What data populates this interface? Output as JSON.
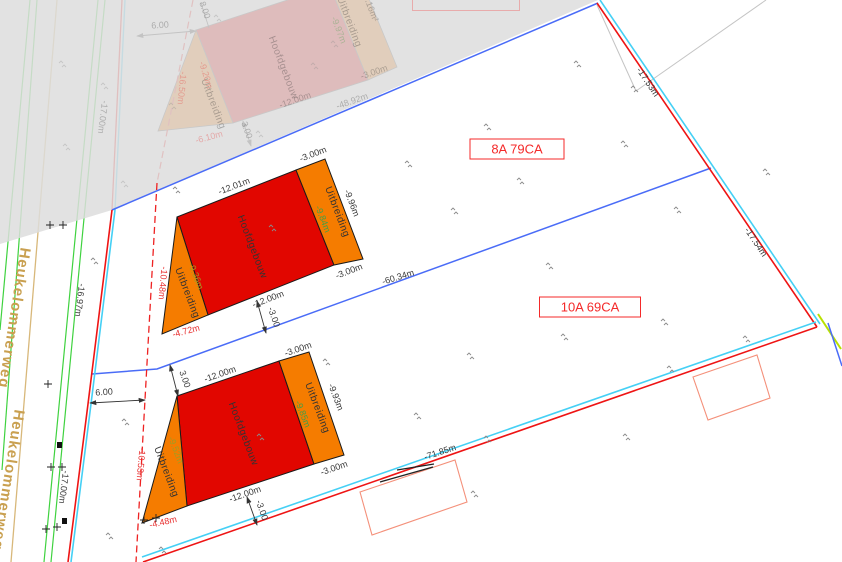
{
  "map": {
    "street_name": "Heukelommerweg",
    "parcel_labels": {
      "upper": "8A 79CA",
      "lower": "10A 69CA"
    },
    "boundary_dims": {
      "right_upper": "-17.53m",
      "right_lower": "-17.54m",
      "middle": "-60.34m",
      "bottom": "-71.85m",
      "left_upper": "-16.97m",
      "left_lower": "-17.00m",
      "road_offset": "6.00"
    },
    "building_upper": {
      "main_label": "Hoofdgebouw",
      "ext_label": "Uitbreiding",
      "width_top": "-12.01m",
      "width_bottom": "-12.00m",
      "ext_width_top": "-3.00m",
      "ext_width_bottom": "-3.00m",
      "ext_depth_inner": "-9.84m",
      "ext_depth_outer": "-9.96m",
      "left_depth": "-9.36m",
      "left_edge": "-10.48m",
      "left_base": "-4.72m",
      "offset_to_boundary": "-3.00"
    },
    "building_lower": {
      "main_label": "Hoofdgebouw",
      "ext_label": "Uitbreiding",
      "width_top": "-12.00m",
      "width_bottom": "-12.00m",
      "ext_width_top": "-3.00m",
      "ext_width_bottom": "-3.00m",
      "ext_depth_inner": "-9.85m",
      "ext_depth_outer": "-9.93m",
      "left_depth": "-9.52m",
      "left_edge": "-10.53m",
      "left_base": "-4.48m",
      "offset_top": "3.00",
      "offset_bottom": "-3.00"
    },
    "building_faded": {
      "main_label": "Hoofdgebouw",
      "ext_label": "Uitbreiding",
      "width": "-12.00m",
      "ext_width": "-3.00m",
      "ext_depth": "-9.97m",
      "area_note": "0.16m²",
      "boundary_length": "-48.92m",
      "road_offset": "6.00",
      "dim_8": "8.00",
      "dim_3": "3.00",
      "left_inner": "-9.20m",
      "left_edge": "-16.50m",
      "left_base": "-6.10m",
      "left_boundary": "-17.00m"
    },
    "colors": {
      "building_main": "#e10600",
      "building_ext": "#f57c00",
      "parcel_boundary_red": "#e81416",
      "parcel_boundary_cyan": "#45d0f5",
      "divider_blue": "#4a6cf7",
      "road_green": "#3fd23f",
      "road_tan": "#d8b87a",
      "label_red": "#f42a2a",
      "measure_green": "#43a047",
      "measure_olive": "#9e9d24",
      "highlight_yellowgreen": "#b8e000"
    },
    "survey_markers": [
      {
        "x": 483,
        "y": 123
      },
      {
        "x": 620,
        "y": 140
      },
      {
        "x": 516,
        "y": 177
      },
      {
        "x": 404,
        "y": 160
      },
      {
        "x": 630,
        "y": 85
      },
      {
        "x": 573,
        "y": 60
      },
      {
        "x": 172,
        "y": 186
      },
      {
        "x": 268,
        "y": 224
      },
      {
        "x": 450,
        "y": 207
      },
      {
        "x": 673,
        "y": 206
      },
      {
        "x": 762,
        "y": 168
      },
      {
        "x": 545,
        "y": 262
      },
      {
        "x": 660,
        "y": 318
      },
      {
        "x": 742,
        "y": 335
      },
      {
        "x": 666,
        "y": 365
      },
      {
        "x": 466,
        "y": 352
      },
      {
        "x": 560,
        "y": 333
      },
      {
        "x": 322,
        "y": 358
      },
      {
        "x": 413,
        "y": 412
      },
      {
        "x": 256,
        "y": 433
      },
      {
        "x": 470,
        "y": 490
      },
      {
        "x": 622,
        "y": 433
      },
      {
        "x": 483,
        "y": 435
      },
      {
        "x": 90,
        "y": 257
      },
      {
        "x": 121,
        "y": 418
      },
      {
        "x": 158,
        "y": 546
      },
      {
        "x": 105,
        "y": 532
      },
      {
        "x": 213,
        "y": 14,
        "f": 1
      },
      {
        "x": 310,
        "y": 62,
        "f": 1
      },
      {
        "x": 100,
        "y": 82,
        "f": 1
      },
      {
        "x": 62,
        "y": 143,
        "f": 1
      },
      {
        "x": 168,
        "y": 102,
        "f": 1
      },
      {
        "x": 120,
        "y": 180,
        "f": 1
      },
      {
        "x": 255,
        "y": 130,
        "f": 1
      },
      {
        "x": 58,
        "y": 60,
        "f": 1
      },
      {
        "x": 330,
        "y": 40,
        "f": 1
      },
      {
        "x": 46,
        "y": 221,
        "t": "plus"
      },
      {
        "x": 59,
        "y": 221,
        "t": "plus"
      },
      {
        "x": 47,
        "y": 463,
        "t": "plus"
      },
      {
        "x": 58,
        "y": 463,
        "t": "plus"
      },
      {
        "x": 42,
        "y": 525,
        "t": "plus"
      },
      {
        "x": 53,
        "y": 523,
        "t": "plus"
      },
      {
        "x": 140,
        "y": 516,
        "t": "plus"
      },
      {
        "x": 152,
        "y": 514,
        "t": "plus"
      },
      {
        "x": 44,
        "y": 380,
        "t": "plus"
      },
      {
        "x": 57,
        "y": 442,
        "t": "square"
      },
      {
        "x": 62,
        "y": 518,
        "t": "square"
      }
    ]
  }
}
